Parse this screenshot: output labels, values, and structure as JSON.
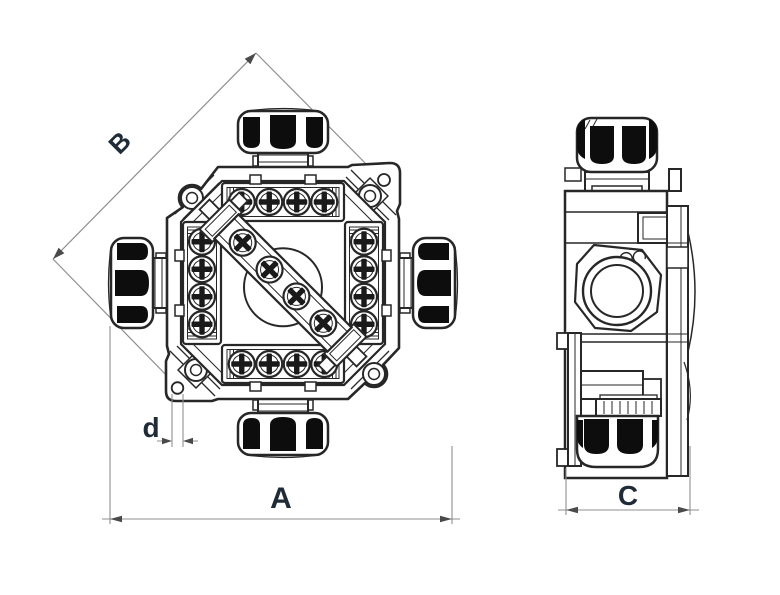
{
  "drawing": {
    "labels": {
      "a": "A",
      "b": "B",
      "c": "C",
      "d": "d"
    }
  },
  "colors": {
    "outline": "#272727",
    "dimension_line": "#8f8f8f",
    "arrow": "#4a4a4a",
    "label": "#202b38",
    "gland_fill": "#0d0d0d",
    "background": "#ffffff"
  }
}
